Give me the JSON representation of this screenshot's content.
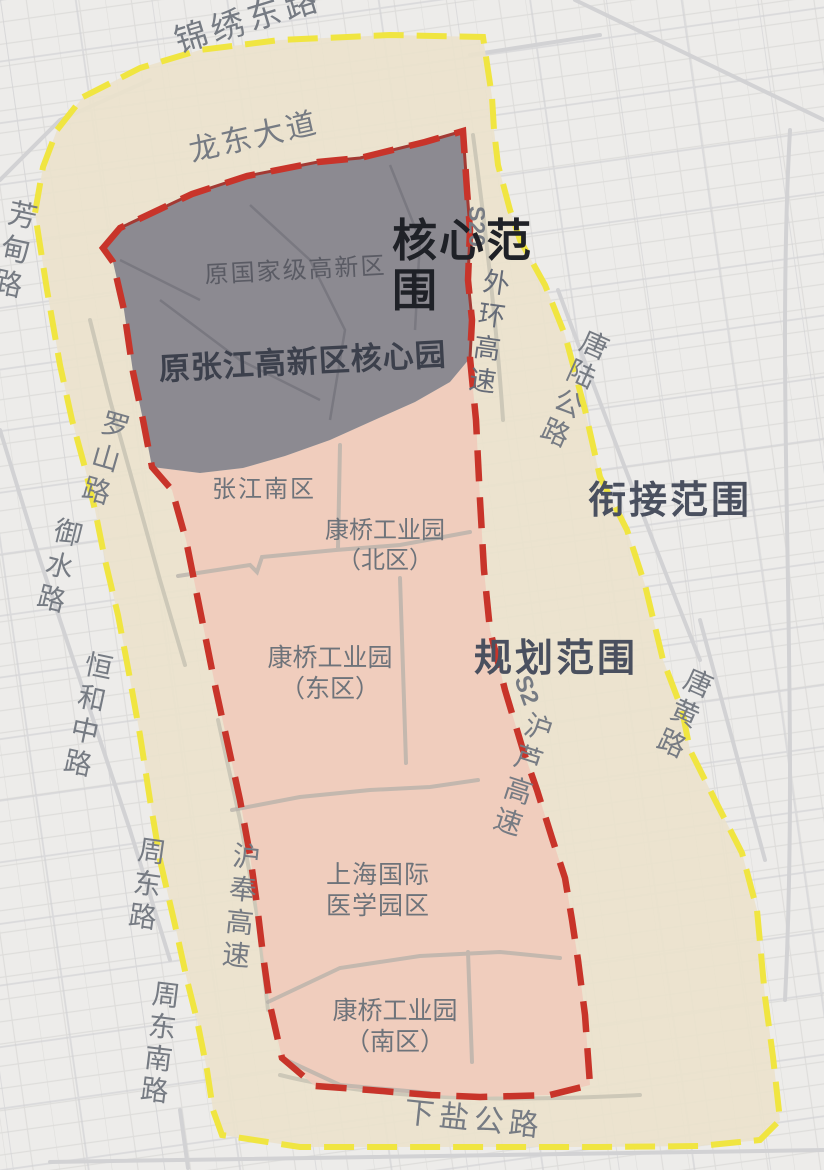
{
  "map": {
    "zones": {
      "core_big": "核心范围",
      "connection_big": "衔接范围",
      "planning_big": "规划范围",
      "former_national": "原国家级高新区",
      "former_zhangjiang_core": "原张江高新区核心园",
      "zhangjiang_south": "张江南区",
      "kangqiao_north_line1": "康桥工业园",
      "kangqiao_north_line2": "（北区）",
      "kangqiao_east_line1": "康桥工业园",
      "kangqiao_east_line2": "（东区）",
      "medical_line1": "上海国际",
      "medical_line2": "医学园区",
      "kangqiao_south_line1": "康桥工业园",
      "kangqiao_south_line2": "（南区）"
    },
    "roads": {
      "jinxiu_east_rd": "锦绣东路",
      "longdong_ave": "龙东大道",
      "fangdian_rd": "芳甸路",
      "s20_badge": "S20",
      "waihuan_expwy": "外环高速",
      "tanglu_hwy": "唐陆公路",
      "luoshan_rd": "罗山路",
      "yushui_rd": "御水路",
      "henghe_middle_rd": "恒和中路",
      "zhoudong_rd": "周东路",
      "zhoudongnan_rd": "周东南路",
      "hufeng_expwy": "沪奉高速",
      "s2_badge": "S2",
      "hulu_expwy": "沪芦高速",
      "tanghuang_rd": "唐黄路",
      "xiayan_hwy": "下盐公路"
    },
    "colors": {
      "map_background": "#edecea",
      "core_fill": "#87868f",
      "planning_fill": "#f0cabb",
      "connection_fill": "#ebe2cc",
      "planning_boundary": "#c8342a",
      "connection_boundary": "#f0e541"
    }
  }
}
